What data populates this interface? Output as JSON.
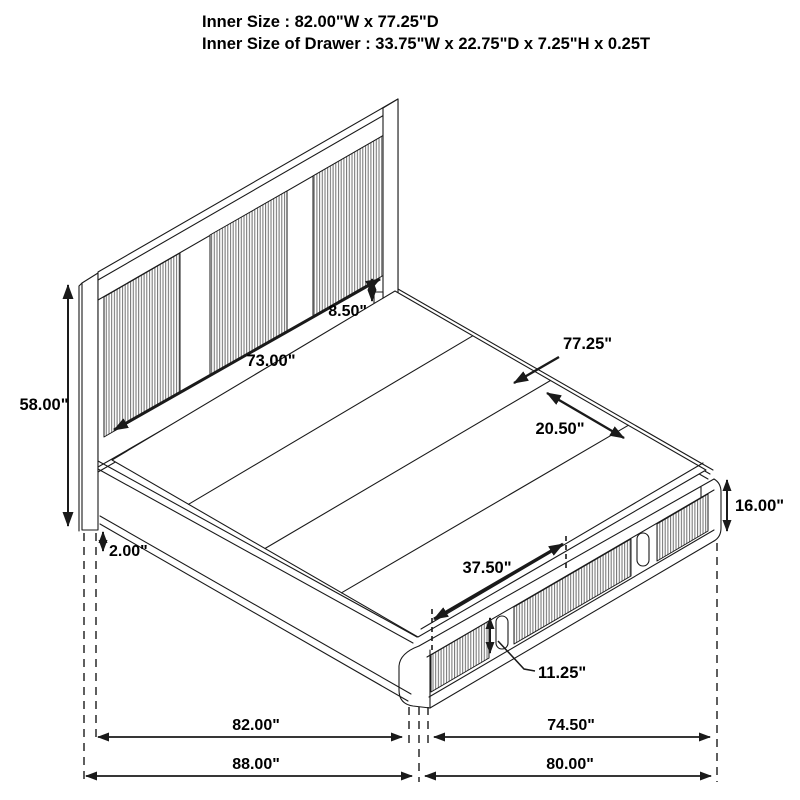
{
  "figure": {
    "title_line1": "Inner Size : 82.00\"W x 77.25\"D",
    "title_line2": "Inner Size of Drawer : 33.75\"W x 22.75\"D x 7.25\"H x 0.25T"
  },
  "dimensions": {
    "headboard_height": "58.00\"",
    "inner_width": "73.00\"",
    "panel_gap": "8.50\"",
    "inner_depth": "77.25\"",
    "slat_panel_width": "20.50\"",
    "footboard_height": "16.00\"",
    "rail_floor_gap": "2.00\"",
    "drawer_front_width": "37.50\"",
    "drawer_front_height": "11.25\"",
    "base_width": "82.00\"",
    "base_depth": "74.50\"",
    "overall_width": "88.00\"",
    "overall_depth": "80.00\""
  },
  "colors": {
    "line": "#1a1a1a",
    "label": "#000000",
    "flute_line": "#6f6f6f",
    "background": "#ffffff"
  }
}
